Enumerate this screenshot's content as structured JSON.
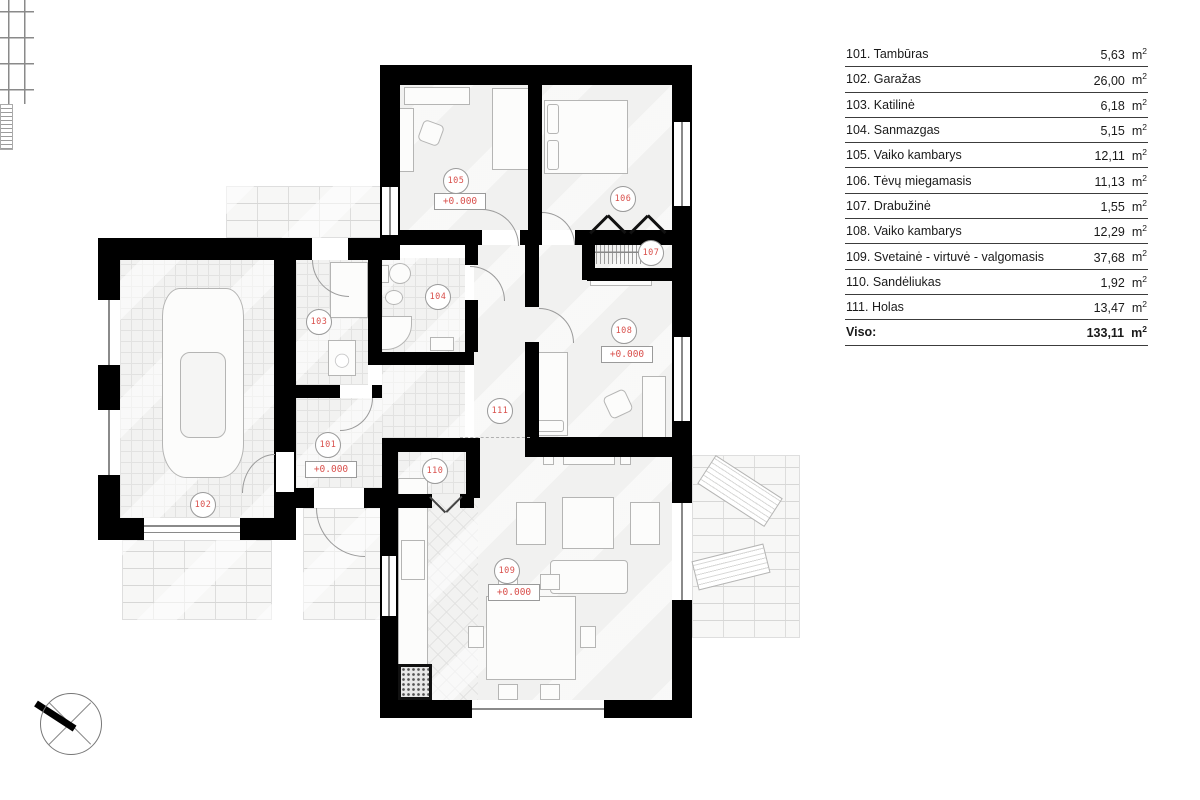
{
  "legend": {
    "rows": [
      {
        "label": "101. Tambūras",
        "area": "5,63"
      },
      {
        "label": "102. Garažas",
        "area": "26,00"
      },
      {
        "label": "103. Katilinė",
        "area": "6,18"
      },
      {
        "label": "104. Sanmazgas",
        "area": "5,15"
      },
      {
        "label": "105. Vaiko kambarys",
        "area": "12,11"
      },
      {
        "label": "106. Tėvų miegamasis",
        "area": "11,13"
      },
      {
        "label": "107. Drabužinė",
        "area": "1,55"
      },
      {
        "label": "108. Vaiko kambarys",
        "area": "12,29"
      },
      {
        "label": "109. Svetainė - virtuvė - valgomasis",
        "area": "37,68"
      },
      {
        "label": "110. Sandėliukas",
        "area": "1,92"
      },
      {
        "label": "111. Holas",
        "area": "13,47"
      }
    ],
    "unit_base": "m",
    "unit_exp": "2",
    "total_label": "Viso:",
    "total_area": "133,11"
  },
  "plan": {
    "room_labels": [
      {
        "id": "101",
        "elevation": "+0.000"
      },
      {
        "id": "102"
      },
      {
        "id": "103"
      },
      {
        "id": "104"
      },
      {
        "id": "105",
        "elevation": "+0.000"
      },
      {
        "id": "106"
      },
      {
        "id": "107"
      },
      {
        "id": "108",
        "elevation": "+0.000"
      },
      {
        "id": "109",
        "elevation": "+0.000"
      },
      {
        "id": "110"
      },
      {
        "id": "111"
      }
    ],
    "colors": {
      "label_red": "#d9504c",
      "wall": "#000000"
    }
  }
}
